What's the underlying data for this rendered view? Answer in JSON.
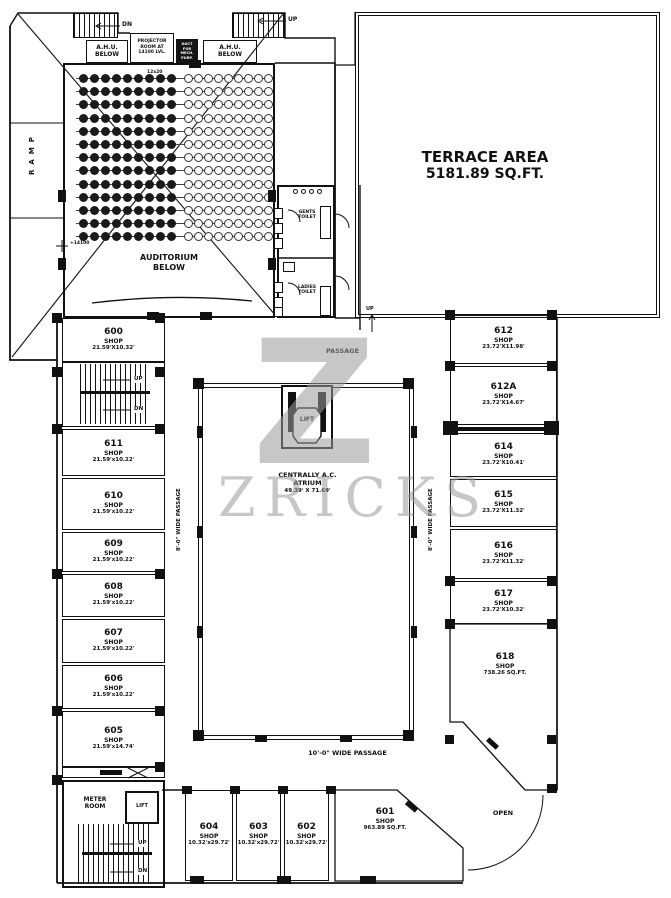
{
  "watermark": {
    "logo": "Z",
    "brand": "ZRICKS",
    "color": "#9b9b9b"
  },
  "colors": {
    "line": "#111111",
    "background": "#ffffff"
  },
  "terrace": {
    "title": "TERRACE AREA",
    "area": "5181.89 SQ.FT."
  },
  "left_block": {
    "ramp": "RAMP",
    "stair_top_left": "DN",
    "stair_top_right": "UP",
    "ahu_left_l1": "A.H.U.",
    "ahu_left_l2": "BELOW",
    "ahu_right_l1": "A.H.U.",
    "ahu_right_l2": "BELOW",
    "projector": "PROJECTOR ROOM AT 14100 LVL.",
    "duct": "DUCT FOR MECH. PURP.",
    "auditorium_l1": "AUDITORIUM",
    "auditorium_l2": "BELOW",
    "level_marker": "+14100",
    "seat_note": "12x20"
  },
  "toilets": {
    "gents_l1": "GENTS",
    "gents_l2": "TOILET",
    "ladies_l1": "LADIES",
    "ladies_l2": "TOILET",
    "stair_up": "UP"
  },
  "passages": {
    "top": "PASSAGE",
    "left": "8'-0\" WIDE PASSAGE",
    "right": "8'-0\" WIDE PASSAGE",
    "bottom": "10'-0\" WIDE PASSAGE"
  },
  "atrium": {
    "l1": "CENTRALLY A.C.",
    "l2": "ATRIUM",
    "dim": "49.39' X 71.69'",
    "lift": "LIFT"
  },
  "mid_stairs": {
    "up": "UP",
    "dn": "DN"
  },
  "core": {
    "meter_l1": "METER",
    "meter_l2": "ROOM",
    "lift": "LIFT",
    "up": "UP",
    "dn": "DN"
  },
  "open_label": "OPEN",
  "shops": [
    {
      "no": "600",
      "type": "SHOP",
      "dim": "21.59'X10.32'"
    },
    {
      "no": "611",
      "type": "SHOP",
      "dim": "21.59'x10.22'"
    },
    {
      "no": "610",
      "type": "SHOP",
      "dim": "21.59'x10.22'"
    },
    {
      "no": "609",
      "type": "SHOP",
      "dim": "21.59'x10.22'"
    },
    {
      "no": "608",
      "type": "SHOP",
      "dim": "21.59'x10.22'"
    },
    {
      "no": "607",
      "type": "SHOP",
      "dim": "21.59'x10.22'"
    },
    {
      "no": "606",
      "type": "SHOP",
      "dim": "21.59'x10.22'"
    },
    {
      "no": "605",
      "type": "SHOP",
      "dim": "21.59'x14.74'"
    },
    {
      "no": "612",
      "type": "SHOP",
      "dim": "23.72'X11.98'"
    },
    {
      "no": "612A",
      "type": "SHOP",
      "dim": "23.72'X14.67'"
    },
    {
      "no": "614",
      "type": "SHOP",
      "dim": "23.72'X10.41'"
    },
    {
      "no": "615",
      "type": "SHOP",
      "dim": "23.72'X11.32'"
    },
    {
      "no": "616",
      "type": "SHOP",
      "dim": "23.72'X11.32'"
    },
    {
      "no": "617",
      "type": "SHOP",
      "dim": "23.72'X10.32'"
    },
    {
      "no": "618",
      "type": "SHOP",
      "dim": "738.26 SQ.FT."
    },
    {
      "no": "604",
      "type": "SHOP",
      "dim": "10.32'x29.72'"
    },
    {
      "no": "603",
      "type": "SHOP",
      "dim": "10.32'x29.72'"
    },
    {
      "no": "602",
      "type": "SHOP",
      "dim": "10.32'x29.72'"
    },
    {
      "no": "601",
      "type": "SHOP",
      "dim": "963.89 SQ.FT."
    }
  ]
}
